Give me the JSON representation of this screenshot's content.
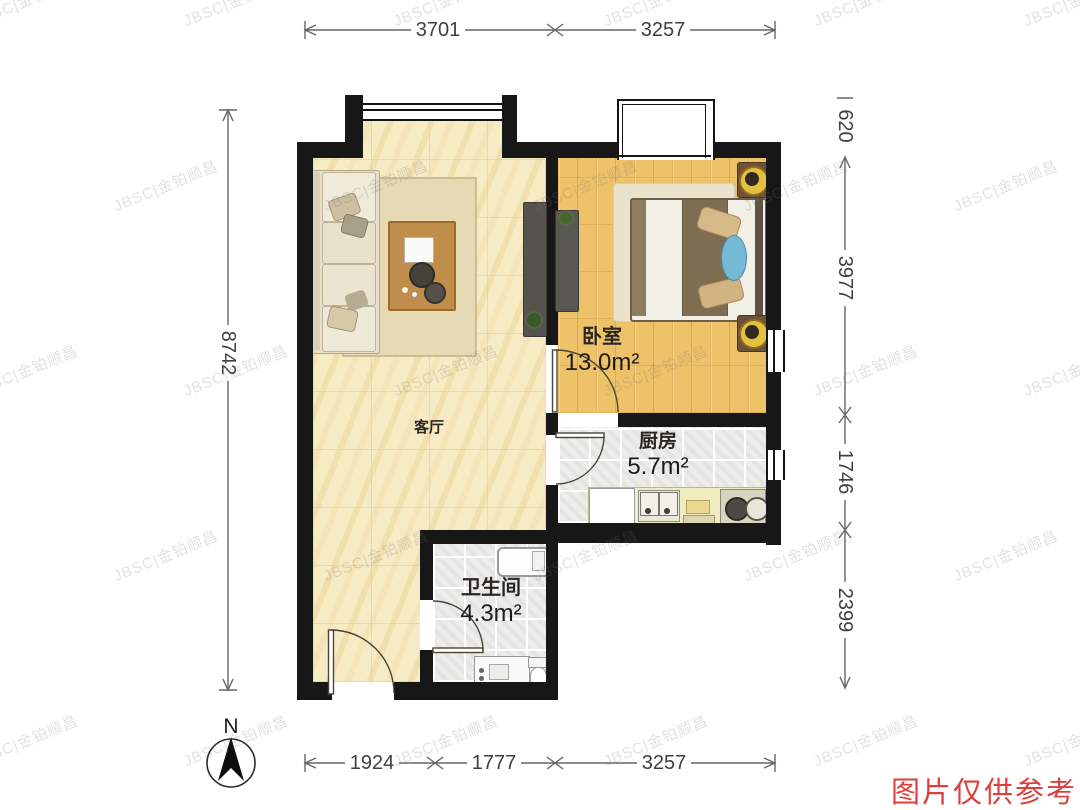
{
  "watermark": {
    "text": "JBSC|金铂顺昌"
  },
  "disclaimer": {
    "text": "图片仅供参考"
  },
  "compass": {
    "label": "N"
  },
  "rooms": {
    "living": {
      "name": "客厅"
    },
    "bedroom": {
      "name": "卧室",
      "area": "13.0m²"
    },
    "kitchen": {
      "name": "厨房",
      "area": "5.7m²"
    },
    "bathroom": {
      "name": "卫生间",
      "area": "4.3m²"
    }
  },
  "dimensions": {
    "top": [
      "3701",
      "3257"
    ],
    "bottom": [
      "1924",
      "1777",
      "3257"
    ],
    "left": [
      "8742"
    ],
    "right": [
      "620",
      "3977",
      "1746",
      "2399"
    ]
  },
  "colors": {
    "wall": "#171717",
    "living_floor": "#f7ebc4",
    "bedroom_floor": "#eec268",
    "tile_floor": "#ecede9",
    "disclaimer_red": "#dd3f3c"
  }
}
